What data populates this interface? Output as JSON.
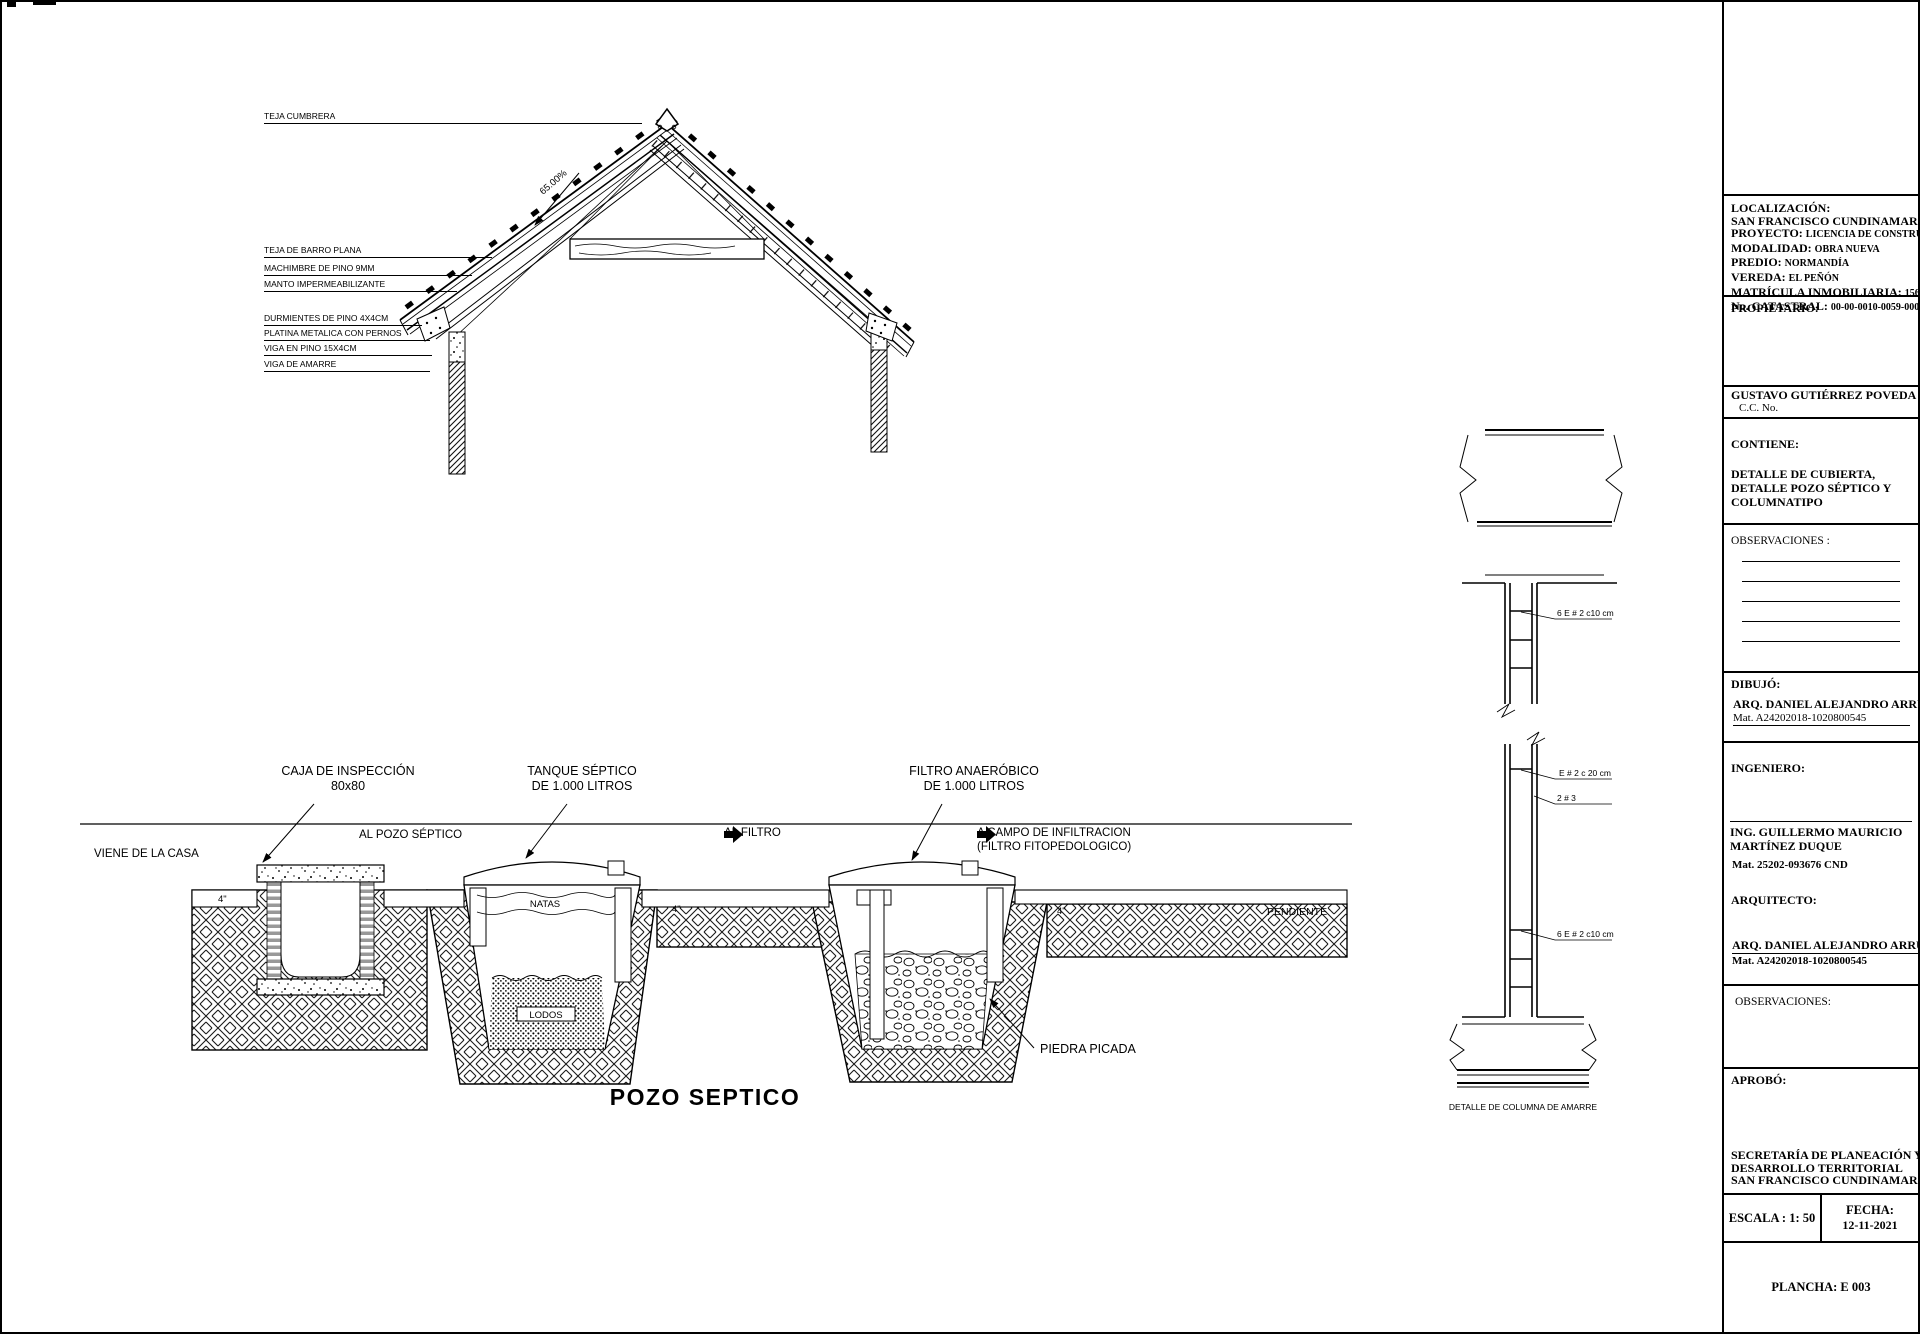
{
  "roof": {
    "slope": "65.00%",
    "labels": {
      "teja_cumbrera": "TEJA CUMBRERA",
      "teja_barro": "TEJA DE BARRO PLANA",
      "machimbre": "MACHIMBRE DE PINO 9MM",
      "manto": "MANTO IMPERMEABILIZANTE",
      "durmientes": "DURMIENTES DE PINO 4X4CM",
      "platina": "PLATINA METALICA CON PERNOS",
      "viga_pino": "VIGA EN PINO 15X4CM",
      "viga_amarre": "VIGA DE AMARRE"
    }
  },
  "septic": {
    "title": "POZO SEPTICO",
    "caja_line1": "CAJA DE INSPECCIÓN",
    "caja_line2": "80x80",
    "tanque_line1": "TANQUE SÉPTICO",
    "tanque_line2": "DE 1.000 LITROS",
    "filtro_line1": "FILTRO  ANAERÓBICO",
    "filtro_line2": "DE 1.000 LITROS",
    "viene_casa": "VIENE DE LA CASA",
    "al_pozo": "AL POZO SÉPTICO",
    "al_filtro": "AL FILTRO",
    "a_campo_line1": "A CAMPO DE INFILTRACION",
    "a_campo_line2": "(FILTRO FITOPEDOLOGICO)",
    "natas": "NATAS",
    "lodos": "LODOS",
    "piedra_picada": "PIEDRA PICADA",
    "pendiente": "PENDIENTE",
    "pipe_diameter": "4\""
  },
  "column": {
    "stirrups_top": "6 E # 2 c10 cm",
    "stirrups_mid": "E # 2 c 20 cm",
    "rebar": "2 # 3",
    "stirrups_bottom": "6 E # 2 c10 cm",
    "caption": "DETALLE DE COLUMNA DE AMARRE"
  },
  "titleblock": {
    "localizacion_label": "LOCALIZACIÓN:",
    "localizacion_value": "SAN FRANCISCO CUNDINAMARCA",
    "proyecto_label": "PROYECTO:",
    "proyecto_value": "LICENCIA DE CONSTRUCCIÓN",
    "modalidad_label": "MODALIDAD:",
    "modalidad_value": "OBRA NUEVA",
    "predio_label": "PREDIO:",
    "predio_value": "NORMANDÍA",
    "vereda_label": "VEREDA:",
    "vereda_value": "EL PEÑÓN",
    "matricula_label": "MATRÍCULA INMOBILIARIA:",
    "matricula_value": "156-3844",
    "catastral_label": "No. CATASTRAL:",
    "catastral_value": "00-00-0010-0059-000",
    "propietario_label": "PROPIETARIO:",
    "propietario_nombre": "GUSTAVO GUTIÉRREZ POVEDA",
    "cc": "C.C. No.",
    "contiene_label": "CONTIENE:",
    "contiene_value": "DETALLE DE CUBIERTA, DETALLE POZO SÉPTICO Y COLUMNATIPO",
    "observaciones1": "OBSERVACIONES :",
    "dibujo_label": "DIBUJÓ:",
    "dibujo_nombre": "ARQ. DANIEL ALEJANDRO ARRUBLA",
    "dibujo_mat": "Mat. A24202018-1020800545",
    "ingeniero_label": "INGENIERO:",
    "ingeniero_nombre": "ING. GUILLERMO MAURICIO MARTÍNEZ DUQUE",
    "ingeniero_mat": "Mat. 25202-093676 CND",
    "arquitecto_label": "ARQUITECTO:",
    "arquitecto_nombre": "ARQ. DANIEL ALEJANDRO ARRUBLA",
    "arquitecto_mat": "Mat. A24202018-1020800545",
    "observaciones2": "OBSERVACIONES:",
    "aprobo_label": "APROBÓ:",
    "aprobo_line1": "SECRETARÍA DE PLANEACIÓN Y",
    "aprobo_line2": "DESARROLLO TERRITORIAL",
    "aprobo_line3": "SAN FRANCISCO CUNDINAMARCA",
    "escala": "ESCALA : 1: 50",
    "fecha_label": "FECHA:",
    "fecha_value": "12-11-2021",
    "plancha": "PLANCHA: E 003"
  },
  "colors": {
    "line": "#000000",
    "paper": "#ffffff"
  }
}
